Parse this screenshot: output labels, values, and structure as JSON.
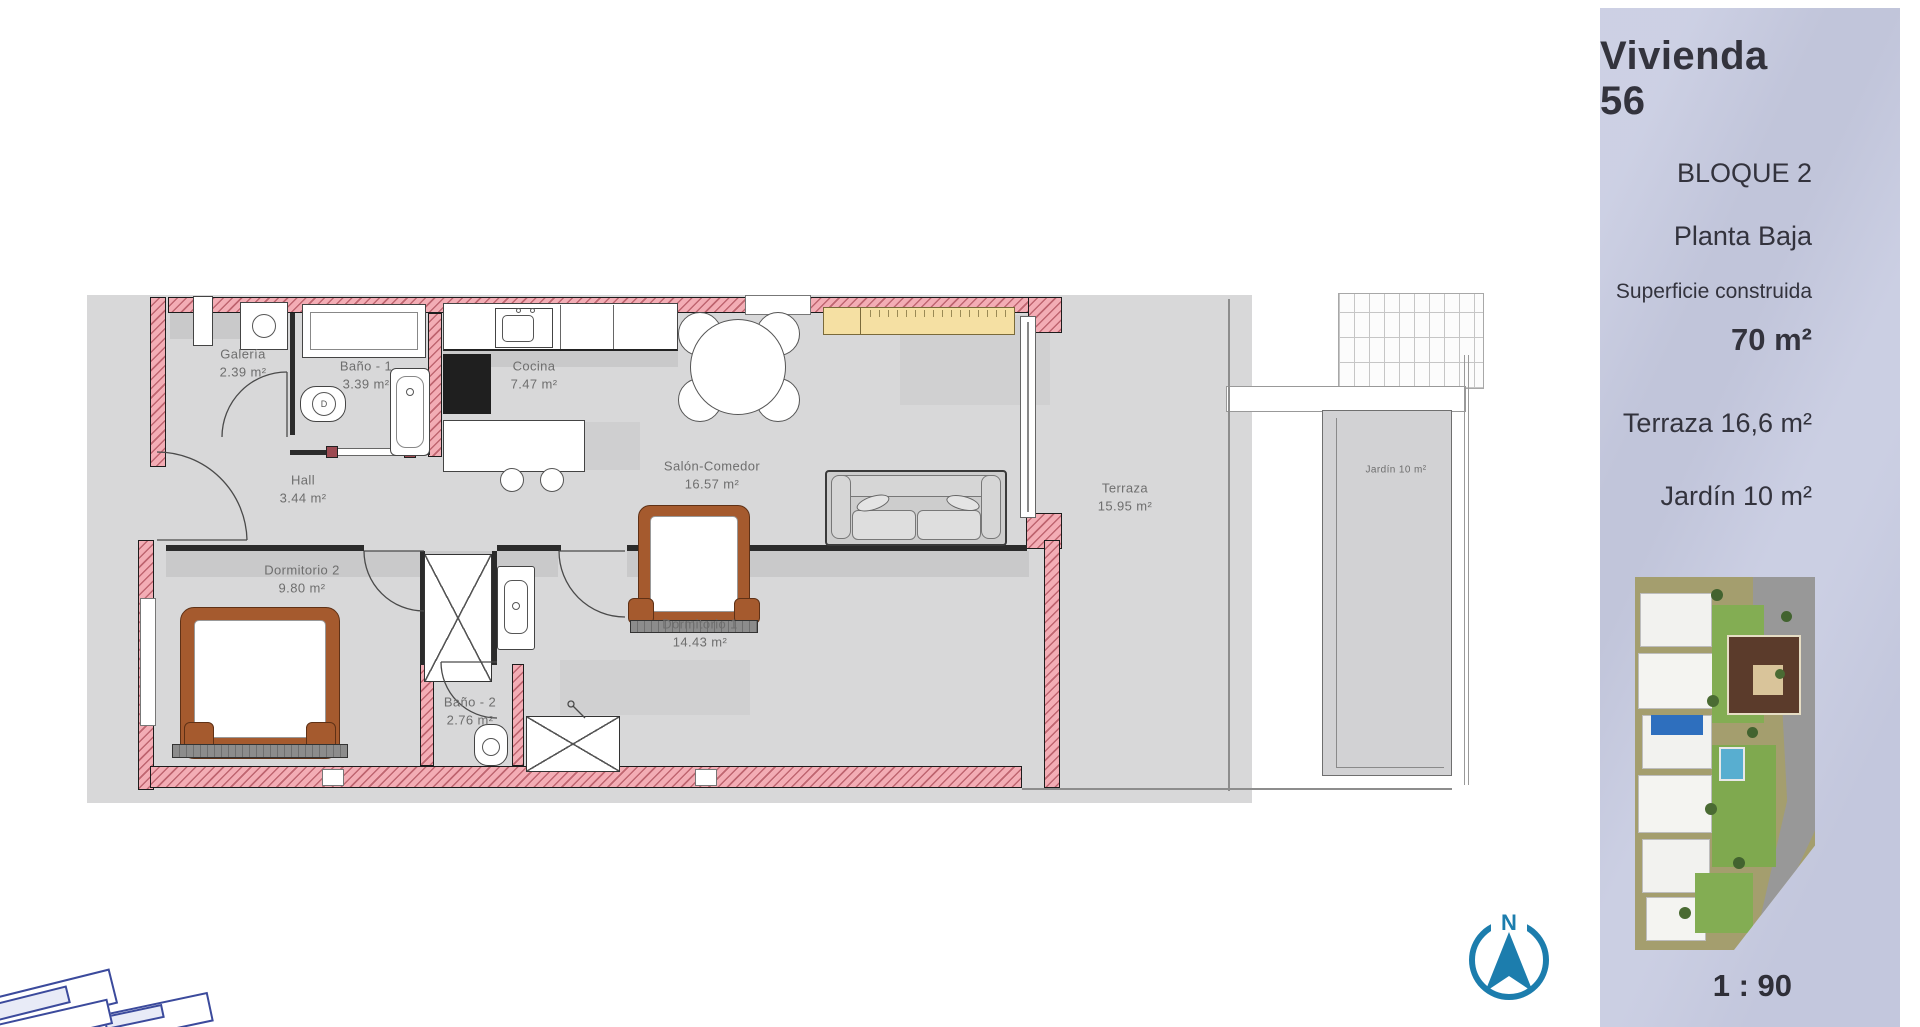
{
  "page": {
    "scale_label": "1 : 90"
  },
  "sidebar": {
    "title": "Vivienda 56",
    "block": "BLOQUE 2",
    "floor": "Planta Baja",
    "surface_label": "Superficie construida",
    "surface_value": "70 m²",
    "terrace_line": "Terraza 16,6 m²",
    "garden_line": "Jardín 10 m²"
  },
  "compass": {
    "north_label": "N"
  },
  "plan": {
    "toilet_label": "D",
    "rooms": [
      {
        "name": "Galería",
        "area": "2.39 m²"
      },
      {
        "name": "Baño - 1",
        "area": "3.39 m²"
      },
      {
        "name": "Cocina",
        "area": "7.47 m²"
      },
      {
        "name": "Salón-Comedor",
        "area": "16.57 m²"
      },
      {
        "name": "Hall",
        "area": "3.44 m²"
      },
      {
        "name": "Dormitorio 2",
        "area": "9.80 m²"
      },
      {
        "name": "Dormitorio 1",
        "area": "14.43 m²"
      },
      {
        "name": "Baño - 2",
        "area": "2.76 m²"
      },
      {
        "name": "Terraza",
        "area": "15.95 m²"
      },
      {
        "name": "Jardín 10 m²",
        "area": ""
      }
    ]
  },
  "colors": {
    "wall_pink": "#f3adb5",
    "floor_gray": "#d8d8d9",
    "sidebar_lavender": "#c7cbe1",
    "compass_blue": "#1c7dad",
    "sideboard_yellow": "#f5e0a3",
    "bed_brown": "#a55a2e",
    "unit_marker_blue": "#2e6fbe"
  }
}
